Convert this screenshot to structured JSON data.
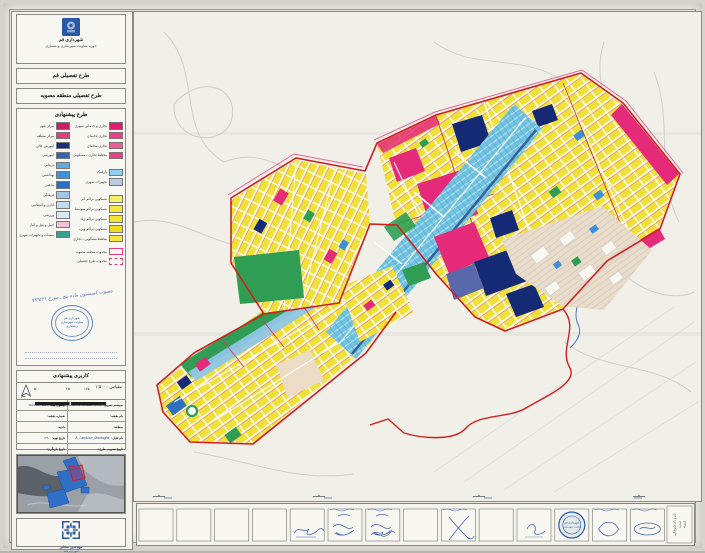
{
  "header": {
    "org": "شهرداری قم",
    "dept": "حوزه معاونت شهرسازی و معماری",
    "title1": "طرح تفصیلی قم",
    "title2": "طرح تفصیلی منطقه مصوبه"
  },
  "legend": {
    "title": "طرح پیشنهادی",
    "left_items": [
      {
        "label": "مرکز شهر",
        "color": "#cb1d63"
      },
      {
        "label": "مرکز منطقه",
        "color": "#e63b78"
      },
      {
        "label": "آموزش عالی",
        "color": "#1b2d7a"
      },
      {
        "label": "آموزشی",
        "color": "#2f63b5"
      },
      {
        "label": "درمانی",
        "color": "#63a9e0"
      },
      {
        "label": "بهداشتی",
        "color": "#3e92d8"
      },
      {
        "label": "مذهبی",
        "color": "#2a70c2"
      },
      {
        "label": "فرهنگی",
        "color": "#9fc6e8"
      },
      {
        "label": "اداری و انتظامی",
        "color": "#c3dcf0"
      },
      {
        "label": "ورزشی",
        "color": "#d9eaf6"
      },
      {
        "label": "حمل و نقل و انبار",
        "color": "#f0c3d6"
      },
      {
        "label": "تاسیسات و تجهیزات شهری",
        "color": "#35a08f"
      }
    ],
    "right_groups": [
      [
        {
          "label": "تجاری و خدماتی شهری",
          "color": "#dd1f6b",
          "hatch": true
        },
        {
          "label": "تجاری ناحیه‌ای",
          "color": "#ef3d85"
        },
        {
          "label": "تجاری محله‌ای",
          "color": "#f05a97"
        },
        {
          "label": "مختلط تجاری ـ مسکونی",
          "color": "#ef3d85",
          "hatch": true
        }
      ],
      [
        {
          "label": "پارکینگ",
          "color": "#8ecfee"
        },
        {
          "label": "تجهیزات شهری",
          "color": "#b9cbe4"
        }
      ],
      [
        {
          "label": "مسکونی تراکم کم",
          "color": "#f6ef6a"
        },
        {
          "label": "مسکونی تراکم متوسط",
          "color": "#f4e844"
        },
        {
          "label": "مسکونی تراکم زیاد",
          "color": "#f2e232"
        },
        {
          "label": "مسکونی تراکم ویژه",
          "color": "#efdd1e"
        },
        {
          "label": "مختلط مسکونی ـ تجاری",
          "color": "#f4e844",
          "hatch": true
        }
      ]
    ],
    "outline_items": [
      {
        "label": "محدوده منطقه مصوبه",
        "color": "#e63b78",
        "dashed": false
      },
      {
        "label": "محدوده طرح تفصیلی",
        "color": "#e63b78",
        "dashed": true
      }
    ],
    "note": "مصوب کمیسیون ماده پنج ـ مورخ ۹۳/۷/۲۱"
  },
  "stamp": {
    "lines": [
      "شهرداری قم",
      "معاونت شهرسازی",
      "و معماری"
    ]
  },
  "info_table": {
    "title": "کاربری پیشنهادی",
    "scale_label": "مقیاس  ۱:۵۰۰۰",
    "scale_ticks": [
      "۵۰۰",
      "۲۵۰",
      "۱۲۵",
      "۰"
    ],
    "scale_unit": "متر",
    "rows": [
      {
        "r_label": "سیستم تصویر:",
        "r_value": "Universal Transverse Mercator (UTM)",
        "l_label": "بیضوی مبنا:",
        "l_value": "WGS 84 - 1984",
        "hand": false
      },
      {
        "r_label": "نام نقشه:",
        "r_value": "",
        "l_label": "شماره نقشه:",
        "l_value": "",
        "hand": false
      },
      {
        "r_label": "منطقه:",
        "r_value": "",
        "l_label": "ناحیه:",
        "l_value": "",
        "hand": false
      },
      {
        "r_label": "نام فایل:",
        "r_value": "A_Landuse_Mantaghe",
        "l_label": "تاریخ تهیه:",
        "l_value": "۱۳۹۰",
        "hand": true
      },
      {
        "r_label": "تاریخ تصویب طرح:",
        "r_value": "",
        "l_label": "تاریخ بازنگری:",
        "l_value": "",
        "hand": false
      }
    ]
  },
  "firm": {
    "line1": "مهندسین مشاور",
    "line2": "شهر و برنامه"
  },
  "strip": {
    "label_lines": [
      "نام و نام خانوادگی",
      "سمت",
      "امضاء"
    ]
  },
  "map": {
    "colors": {
      "res": "#f0e138",
      "com": "#e42a78",
      "cor": "#72c3e2",
      "nav": "#152a74",
      "grn": "#2f9e54",
      "bei": "#ecdcc6",
      "red": "#d01f1f",
      "riv": "#4f79bd",
      "ink": "#2b4fa5",
      "stamp": "#2a58a8"
    }
  }
}
